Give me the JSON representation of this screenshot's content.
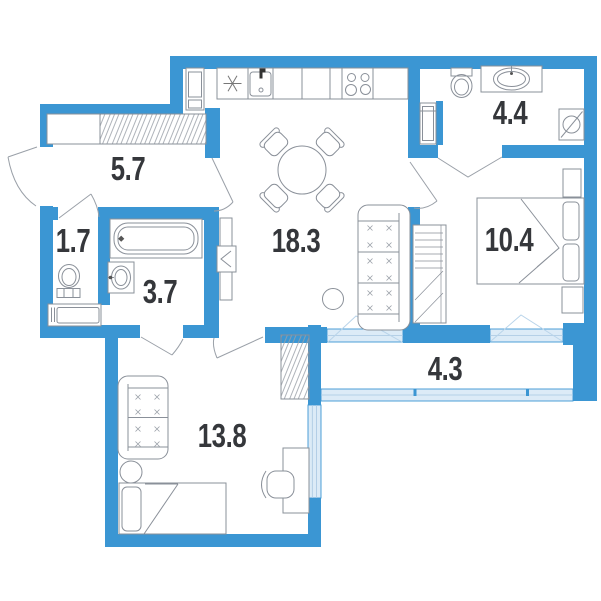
{
  "plan": {
    "type": "apartment-floor-plan",
    "rooms": [
      {
        "id": "hallway",
        "area": "5.7",
        "fixtures": [
          "wardrobe-hatched"
        ]
      },
      {
        "id": "wc",
        "area": "1.7",
        "fixtures": [
          "toilet",
          "low-cabinet"
        ]
      },
      {
        "id": "bathroom",
        "area": "3.7",
        "fixtures": [
          "bathtub",
          "wash-basin"
        ]
      },
      {
        "id": "kitchen-living",
        "area": "18.3",
        "fixtures": [
          "fridge-snowflake",
          "kitchen-sink",
          "stove-4-burner",
          "tall-cabinet",
          "dining-table-4-chairs",
          "sofa",
          "side-table",
          "tv-unit"
        ]
      },
      {
        "id": "ensuite-bathroom",
        "area": "4.4",
        "fixtures": [
          "toilet",
          "counter-basin",
          "washing-machine",
          "cabinet"
        ]
      },
      {
        "id": "bedroom",
        "area": "10.4",
        "fixtures": [
          "double-bed",
          "nightstand",
          "nightstand",
          "wardrobe"
        ]
      },
      {
        "id": "balcony",
        "area": "4.3",
        "fixtures": [
          "glazing"
        ]
      },
      {
        "id": "room",
        "area": "13.8",
        "fixtures": [
          "sofa",
          "single-bed",
          "side-table",
          "desk",
          "chair",
          "wardrobe-hatched",
          "window"
        ]
      }
    ],
    "colors": {
      "wall": "#3b96d3",
      "window_fill": "#dcebf7",
      "window_line": "#a9c7e2",
      "furniture_line": "#8a9099",
      "door_line": "#9aa0a8",
      "label": "#35373b",
      "background": "#ffffff"
    }
  }
}
